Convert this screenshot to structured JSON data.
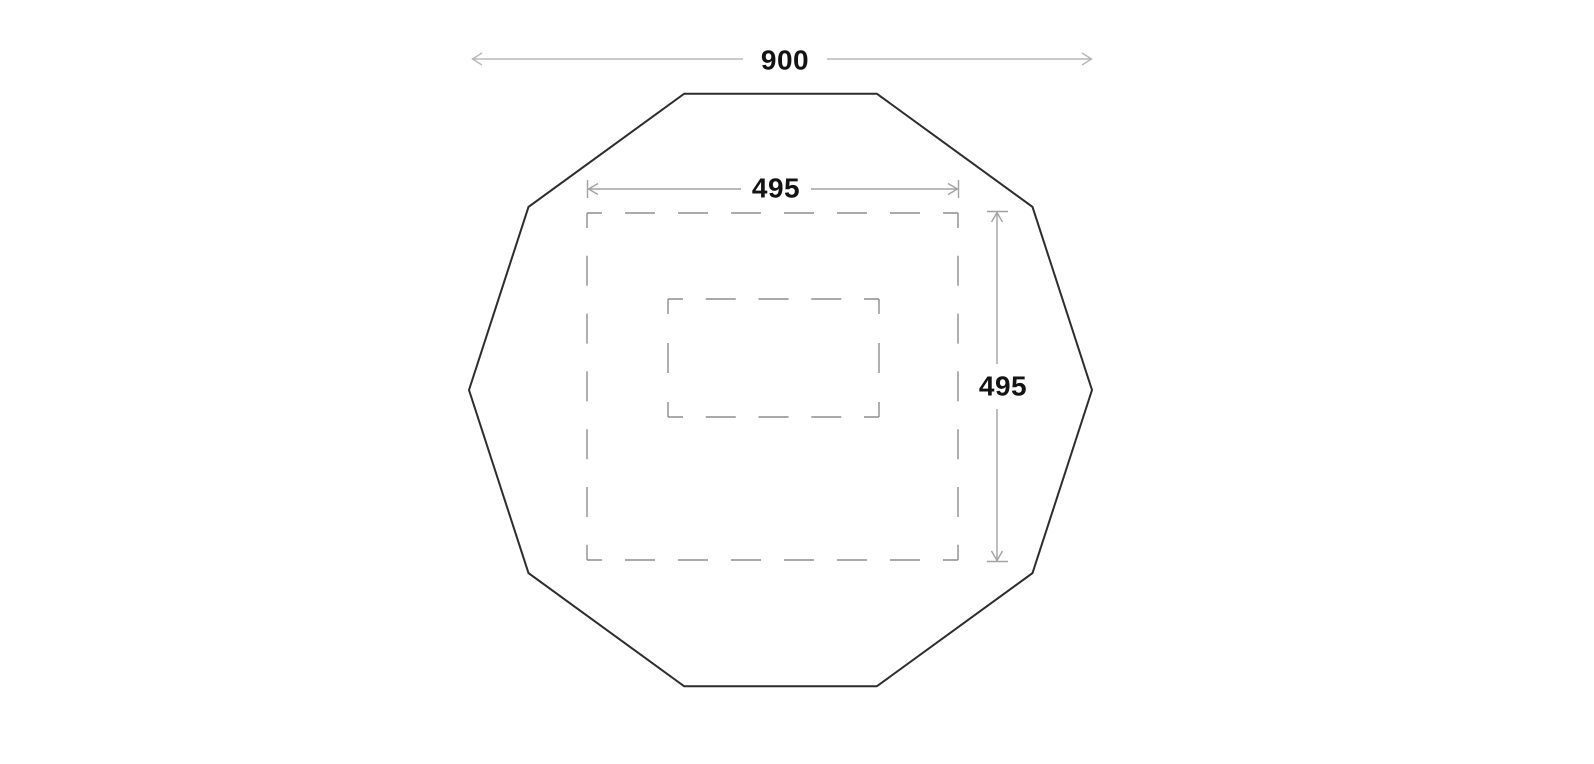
{
  "diagram": {
    "kind": "dimensioned-plan-drawing",
    "shapes": {
      "outer_shape": "decagon-outline",
      "inner_shape": "dashed-square-footprint",
      "center_shape": "dashed-rectangle"
    },
    "dimension_labels": {
      "overall_width": "900",
      "inner_width": "495",
      "inner_height": "495"
    },
    "colors": {
      "background": "#ffffff",
      "shape_outline": "#2d2d2d",
      "dashed_outline": "#8d8d8d",
      "dimension_line_overall": "#b8b8b8",
      "dimension_line_inner": "#a2a2a2",
      "label_text": "#131313"
    }
  }
}
